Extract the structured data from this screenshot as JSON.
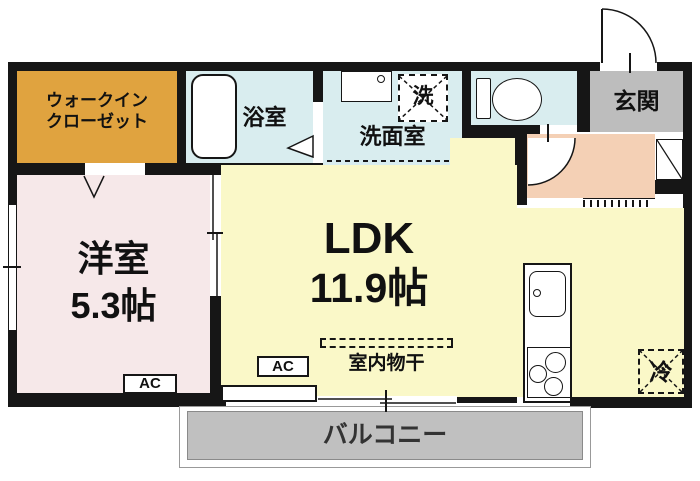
{
  "plan_type": "apartment-floor-plan",
  "rooms": {
    "walk_in_closet": {
      "line1": "ウォークイン",
      "line2": "クローゼット"
    },
    "bathroom": {
      "label": "浴室"
    },
    "washroom": {
      "label": "洗面室"
    },
    "washer_space": {
      "label": "洗"
    },
    "entrance": {
      "label": "玄関"
    },
    "western_room": {
      "name": "洋室",
      "size": "5.3帖"
    },
    "ldk": {
      "name": "LDK",
      "size": "11.9帖"
    },
    "balcony": {
      "label": "バルコニー"
    }
  },
  "fixtures": {
    "ac_western_room": "AC",
    "ac_ldk": "AC",
    "indoor_drying": "室内物干",
    "refrigerator": "冷"
  },
  "colors": {
    "wall": "#161616",
    "walk_in_closet_fill": "#E0A33F",
    "wet_area_fill": "#D9EDEF",
    "western_room_fill": "#F6E8E9",
    "ldk_fill": "#FAF8C8",
    "entrance_fill": "#BDBDBD",
    "hall_fill": "#F4D0B5",
    "balcony_fill": "#C0C0C0"
  }
}
